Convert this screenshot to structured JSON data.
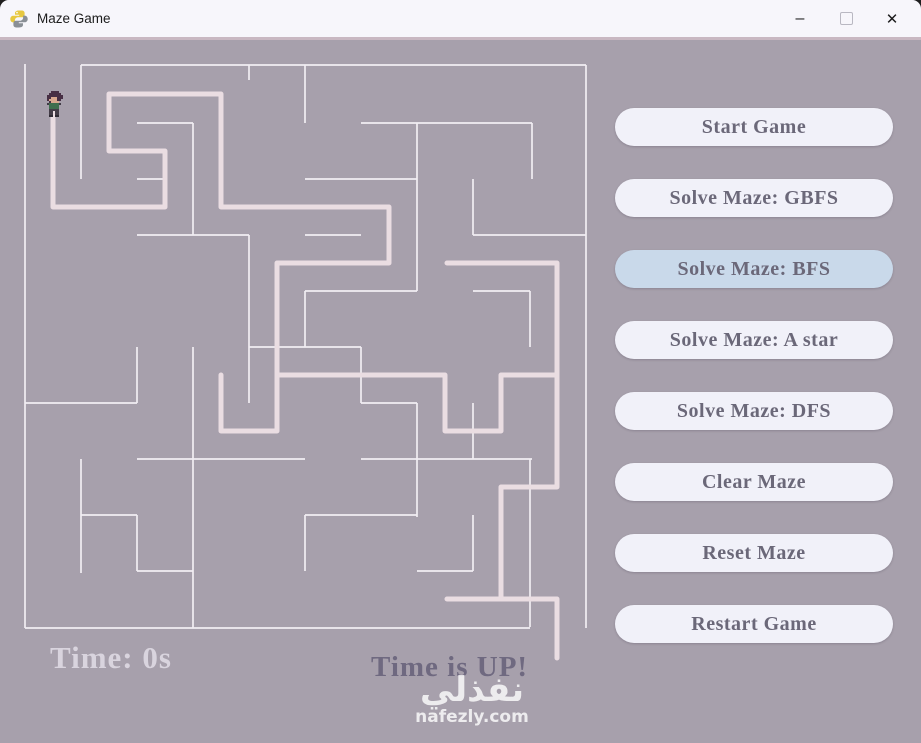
{
  "window": {
    "title": "Maze Game",
    "controls": {
      "minimize": "–",
      "close": "✕"
    }
  },
  "colors": {
    "content_bg": "#a7a0ac",
    "titlebar_bg": "#f7f6fb",
    "divider": "#c9b8c2",
    "button_bg": "#f1f1f9",
    "button_active_bg": "#c9d9ea",
    "button_text": "#6b6879",
    "timer_text": "#d9d4de",
    "message_text": "#6f6980"
  },
  "maze": {
    "wall_color": "#f2eef3",
    "wall_width": 1.7,
    "path_color": "#eadde2",
    "path_width": 5,
    "walls": [
      [
        25,
        64,
        25,
        628
      ],
      [
        81,
        65,
        586,
        65
      ],
      [
        586,
        65,
        586,
        628
      ],
      [
        25,
        628,
        530,
        628
      ],
      [
        81,
        65,
        81,
        179
      ],
      [
        137,
        123,
        193,
        123
      ],
      [
        193,
        123,
        193,
        235
      ],
      [
        249,
        65,
        249,
        80
      ],
      [
        305,
        65,
        305,
        123
      ],
      [
        361,
        123,
        532,
        123
      ],
      [
        417,
        123,
        417,
        291
      ],
      [
        532,
        123,
        532,
        179
      ],
      [
        473,
        179,
        473,
        235
      ],
      [
        473,
        235,
        586,
        235
      ],
      [
        305,
        179,
        417,
        179
      ],
      [
        137,
        235,
        249,
        235
      ],
      [
        249,
        235,
        249,
        403
      ],
      [
        305,
        235,
        361,
        235
      ],
      [
        305,
        291,
        417,
        291
      ],
      [
        305,
        291,
        305,
        347
      ],
      [
        473,
        291,
        530,
        291
      ],
      [
        530,
        291,
        530,
        347
      ],
      [
        249,
        347,
        361,
        347
      ],
      [
        361,
        347,
        361,
        403
      ],
      [
        361,
        403,
        417,
        403
      ],
      [
        417,
        403,
        417,
        517
      ],
      [
        25,
        403,
        137,
        403
      ],
      [
        137,
        347,
        137,
        403
      ],
      [
        81,
        459,
        81,
        573
      ],
      [
        81,
        515,
        137,
        515
      ],
      [
        137,
        515,
        137,
        571
      ],
      [
        361,
        459,
        532,
        459
      ],
      [
        473,
        403,
        473,
        459
      ],
      [
        530,
        459,
        530,
        571
      ],
      [
        305,
        515,
        417,
        515
      ],
      [
        305,
        515,
        305,
        571
      ],
      [
        137,
        571,
        193,
        571
      ],
      [
        193,
        347,
        193,
        628
      ],
      [
        473,
        515,
        473,
        571
      ],
      [
        417,
        571,
        473,
        571
      ],
      [
        530,
        571,
        530,
        627
      ],
      [
        137,
        459,
        305,
        459
      ],
      [
        137,
        179,
        167,
        179
      ]
    ],
    "path_strokes": [
      "M53,98 L53,207 L165,207 L165,151 L109,151 L109,94 L221,94 L221,207 L389,207 L389,263 L277,263 L277,431 L221,431 L221,375",
      "M277,375 L445,375 L445,431 L501,431 L501,375 L557,375",
      "M447,263 L557,263 L557,487 L501,487 L501,599",
      "M447,599 L557,599 L557,658"
    ]
  },
  "player": {
    "x": 47,
    "y": 91,
    "scale": 2,
    "palette": {
      "H": "#472f44",
      "F": "#d8a88f",
      "G": "#3f6e4e",
      "D": "#433c47",
      "B": "#2e2a33"
    },
    "pixels": [
      "..HHHH..",
      ".HHHHHH.",
      "HHHHHHHH",
      "HHFFFHHH",
      "HFFFFHH.",
      ".HFFFF..",
      "DGGGGGD.",
      ".GGGGG..",
      ".GGGGG..",
      ".DDDDD..",
      ".DD.DD..",
      ".DD.DD..",
      ".BB.BB.."
    ]
  },
  "buttons": [
    {
      "label": "Start Game",
      "active": false
    },
    {
      "label": "Solve Maze: GBFS",
      "active": false
    },
    {
      "label": "Solve Maze: BFS",
      "active": true
    },
    {
      "label": "Solve Maze: A star",
      "active": false
    },
    {
      "label": "Solve Maze: DFS",
      "active": false
    },
    {
      "label": "Clear Maze",
      "active": false
    },
    {
      "label": "Reset Maze",
      "active": false
    },
    {
      "label": "Restart Game",
      "active": false
    }
  ],
  "status": {
    "timer": "Time: 0s",
    "message": "Time is UP!"
  },
  "watermark": {
    "arabic": "نفذلي",
    "domain": "nafezly.com"
  }
}
